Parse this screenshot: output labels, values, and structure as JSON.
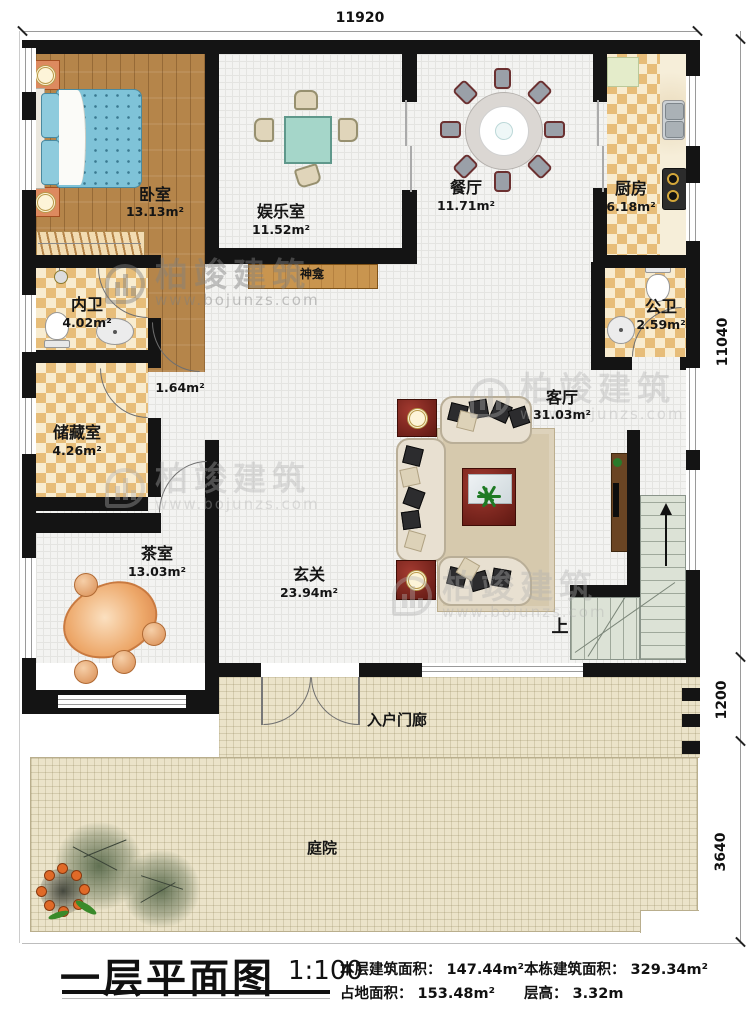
{
  "watermark": {
    "brand": "柏竣建筑",
    "url": "www.bojunzs.com"
  },
  "dimensions": {
    "top_width": "11920",
    "right_upper": "11040",
    "right_middle": "1200",
    "right_lower": "3640"
  },
  "rooms": {
    "bedroom": {
      "name": "卧室",
      "area": "13.13m²"
    },
    "entertainment": {
      "name": "娱乐室",
      "area": "11.52m²"
    },
    "dining": {
      "name": "餐厅",
      "area": "11.71m²"
    },
    "kitchen": {
      "name": "厨房",
      "area": "6.18m²"
    },
    "inner_bath": {
      "name": "内卫",
      "area": "4.02m²"
    },
    "hallway": {
      "area": "1.64m²"
    },
    "storage": {
      "name": "储藏室",
      "area": "4.26m²"
    },
    "public_bath": {
      "name": "公卫",
      "area": "2.59m²"
    },
    "living": {
      "name": "客厅",
      "area": "31.03m²"
    },
    "tea": {
      "name": "茶室",
      "area": "13.03m²"
    },
    "foyer": {
      "name": "玄关",
      "area": "23.94m²"
    },
    "shrine": {
      "name": "神龛"
    },
    "porch": {
      "name": "入户门廊"
    },
    "courtyard": {
      "name": "庭院"
    }
  },
  "stairs": {
    "up_label": "上"
  },
  "titleblock": {
    "title": "一层平面图",
    "scale": "1:100",
    "stats": {
      "floor_area": "本层建筑面积： 147.44m²",
      "building_area": "本栋建筑面积： 329.34m²",
      "footprint": "占地面积： 153.48m²",
      "floor_height": "层高： 3.32m"
    }
  },
  "colors": {
    "wall": "#141414",
    "wood_floor": "#b5854a",
    "checker_dark": "#e7bd79",
    "checker_light": "#f8ecd0",
    "bed": "#7fc3d8",
    "courtyard": "#ebe3c9",
    "stairs": "#dce2d6",
    "table_teal": "#a5d6c9",
    "rosewood": "#8a2a22"
  }
}
